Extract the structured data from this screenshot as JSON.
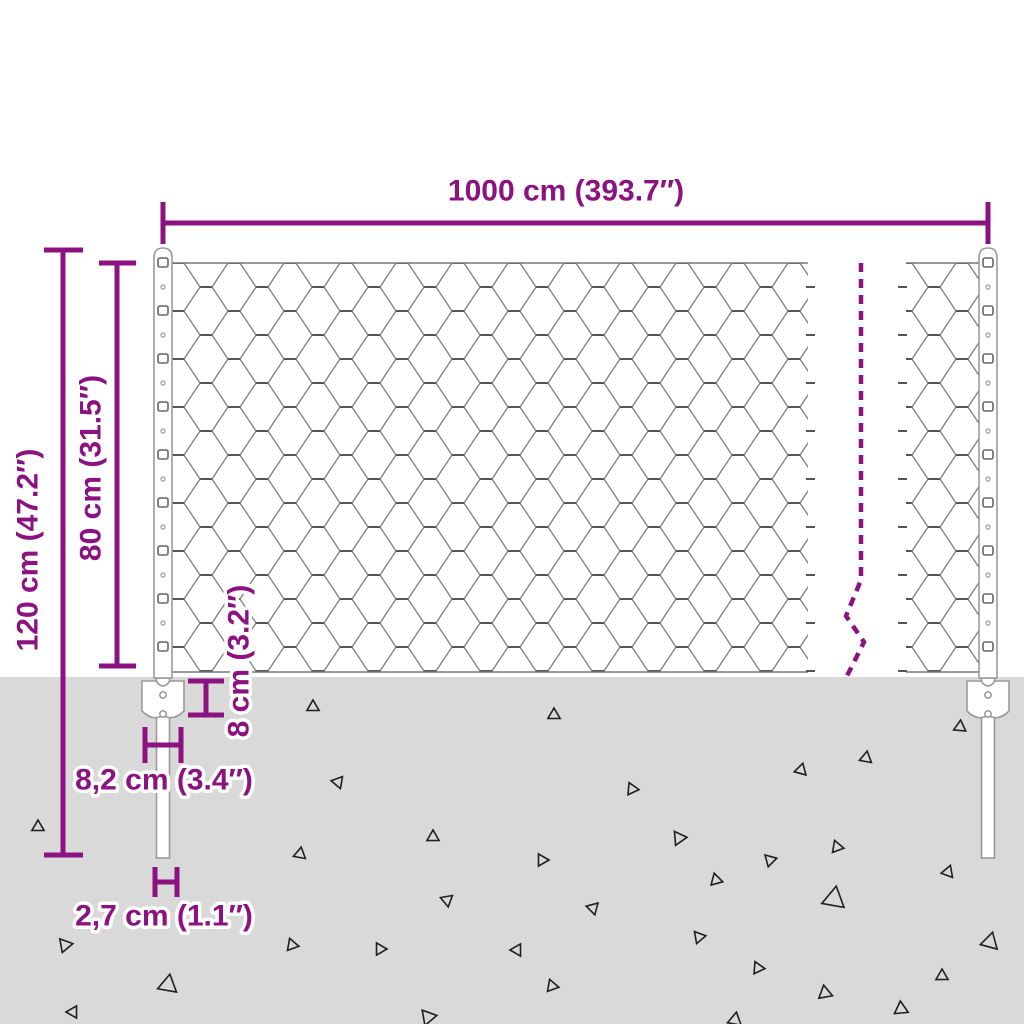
{
  "colors": {
    "accent": "#8b1280",
    "ground": "#d9d9d9",
    "mesh_wire": "#7d7d7d",
    "mesh_twist": "#555555",
    "post_outline": "#9a9a9a",
    "triangle_outline": "#1f1f1f"
  },
  "dimensions": {
    "width_label": "1000 cm (393.7″)",
    "total_height_label": "120 cm (47.2″)",
    "fence_height_label": "80 cm (31.5″)",
    "anchor_depth_label": "8 cm (3.2″)",
    "bracket_width_label": "8,2 cm (3.4″)",
    "post_diameter_label": "2,7 cm (1.1″)"
  },
  "ground": {
    "triangles": [
      {
        "x": 38,
        "y": 827,
        "s": 7,
        "r": 0
      },
      {
        "x": 65,
        "y": 945,
        "s": 8,
        "r": 200
      },
      {
        "x": 73,
        "y": 1012,
        "s": 7,
        "r": 150
      },
      {
        "x": 168,
        "y": 985,
        "s": 11,
        "r": 10
      },
      {
        "x": 292,
        "y": 945,
        "s": 7,
        "r": 100
      },
      {
        "x": 300,
        "y": 854,
        "s": 7,
        "r": 10
      },
      {
        "x": 313,
        "y": 707,
        "s": 7,
        "r": 0
      },
      {
        "x": 338,
        "y": 782,
        "s": 7,
        "r": 40
      },
      {
        "x": 380,
        "y": 949,
        "s": 7,
        "r": 90
      },
      {
        "x": 428,
        "y": 1017,
        "s": 9,
        "r": 80
      },
      {
        "x": 433,
        "y": 837,
        "s": 7,
        "r": 120
      },
      {
        "x": 447,
        "y": 900,
        "s": 7,
        "r": 170
      },
      {
        "x": 517,
        "y": 950,
        "s": 7,
        "r": 30
      },
      {
        "x": 542,
        "y": 860,
        "s": 7,
        "r": 90
      },
      {
        "x": 552,
        "y": 986,
        "s": 7,
        "r": 100
      },
      {
        "x": 554,
        "y": 715,
        "s": 7,
        "r": 0
      },
      {
        "x": 593,
        "y": 908,
        "s": 7,
        "r": 45
      },
      {
        "x": 632,
        "y": 789,
        "s": 7,
        "r": 95
      },
      {
        "x": 679,
        "y": 838,
        "s": 8,
        "r": 85
      },
      {
        "x": 699,
        "y": 937,
        "s": 7,
        "r": 80
      },
      {
        "x": 716,
        "y": 880,
        "s": 7,
        "r": 105
      },
      {
        "x": 735,
        "y": 1020,
        "s": 8,
        "r": 130
      },
      {
        "x": 758,
        "y": 968,
        "s": 7,
        "r": 95
      },
      {
        "x": 770,
        "y": 860,
        "s": 7,
        "r": 75
      },
      {
        "x": 801,
        "y": 770,
        "s": 7,
        "r": 15
      },
      {
        "x": 825,
        "y": 993,
        "s": 8,
        "r": 110
      },
      {
        "x": 834,
        "y": 899,
        "s": 13,
        "r": 250
      },
      {
        "x": 837,
        "y": 847,
        "s": 7,
        "r": 100
      },
      {
        "x": 866,
        "y": 758,
        "s": 7,
        "r": 10
      },
      {
        "x": 901,
        "y": 1009,
        "s": 8,
        "r": 115
      },
      {
        "x": 942,
        "y": 976,
        "s": 7,
        "r": 120
      },
      {
        "x": 948,
        "y": 872,
        "s": 7,
        "r": 260
      },
      {
        "x": 960,
        "y": 727,
        "s": 7,
        "r": 5
      },
      {
        "x": 990,
        "y": 942,
        "s": 10,
        "r": 15
      }
    ]
  }
}
